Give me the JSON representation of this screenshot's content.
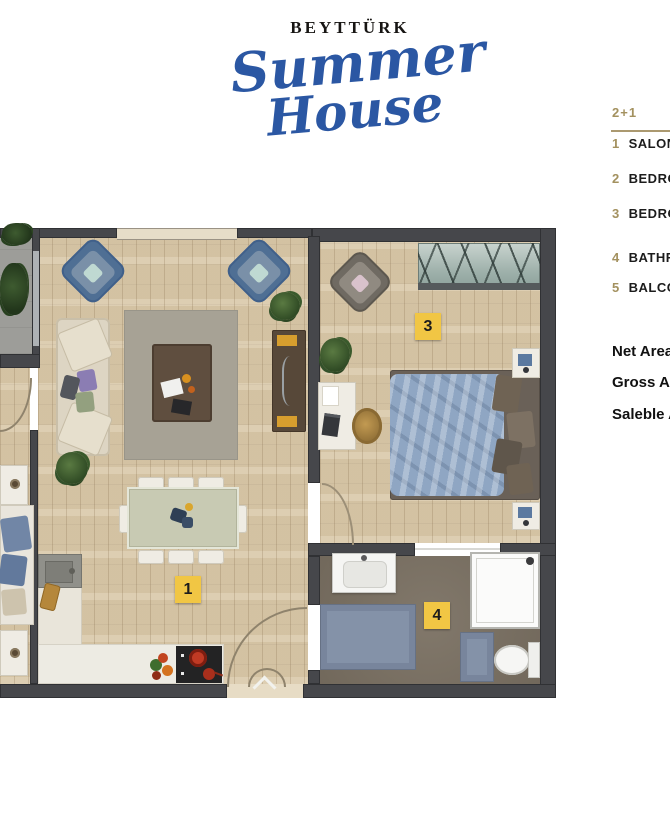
{
  "logo": {
    "brand": "BEYTTÜRK",
    "script_line1": "Summer",
    "script_line2": "House"
  },
  "legend": {
    "unit_type": "2+1",
    "rooms": [
      {
        "num": "1",
        "name": "SALON"
      },
      {
        "num": "2",
        "name": "BEDROOM"
      },
      {
        "num": "3",
        "name": "BEDROOM"
      },
      {
        "num": "4",
        "name": "BATHROOM"
      },
      {
        "num": "5",
        "name": "BALCONY"
      }
    ],
    "areas": [
      {
        "label": "Net Area"
      },
      {
        "label": "Gross Area"
      },
      {
        "label": "Saleble Area"
      }
    ]
  },
  "plan": {
    "badges": {
      "salon": "1",
      "bedroom3": "3",
      "bathroom": "4"
    }
  },
  "colors": {
    "logo_blue": "#2b57a3",
    "legend_gold": "#a3915f",
    "badge_yellow": "#f1c644",
    "wall_gray": "#46474b",
    "bathroom_floor": "#7b7163"
  }
}
